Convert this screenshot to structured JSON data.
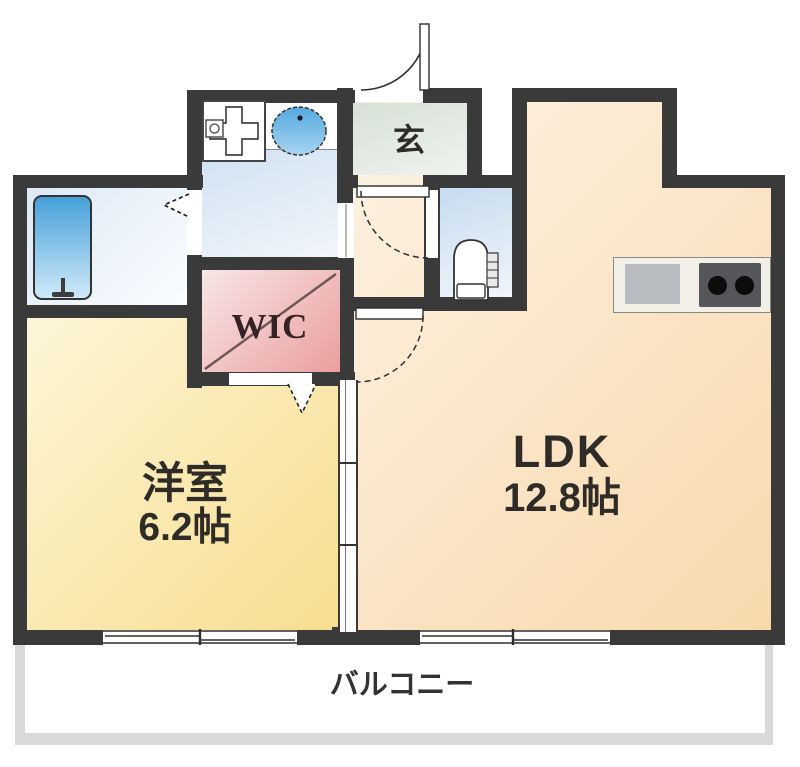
{
  "rooms": {
    "ldk": {
      "name": "LDK",
      "size": "12.8帖"
    },
    "western": {
      "name": "洋室",
      "size": "6.2帖"
    },
    "wic": {
      "name": "WIC"
    },
    "genkan": {
      "name": "玄"
    },
    "balcony": {
      "name": "バルコニー"
    }
  },
  "icons": [
    "bathtub-icon",
    "bath-faucet-icon",
    "washing-machine-pan-icon",
    "sink-icon",
    "toilet-icon",
    "kitchen-stove-icon",
    "entrance-door-icon",
    "toilet-door-icon",
    "western-room-door-icon",
    "folding-door-arrow-icon",
    "wic-door-arrow-icon",
    "sliding-door-icon",
    "window-icon"
  ],
  "colors": {
    "wall": "#3a3a3a",
    "ldk-a": "#fdf2e4",
    "ldk-b": "#f8d9ac",
    "west-a": "#fdf6d8",
    "west-b": "#f7dd8e",
    "wic-a": "#f8e6e6",
    "wic-b": "#eb9e9e",
    "wet-a": "#c7dbf0",
    "wet-b": "#f1f6fb",
    "bath-a": "#dce8f5",
    "bath-b": "#fbfdff",
    "genkan-a": "#d6e1d7",
    "genkan-b": "#eff3ee",
    "tub-a": "#47a0da",
    "tub-b": "#cfe9f9",
    "balcony-border": "#d9d9d9",
    "counter": "#f2efe7",
    "sink-gray": "#b9bcc0",
    "stove": "#55565a",
    "burner": "#0c0c0c",
    "text": "#2f2b27"
  }
}
